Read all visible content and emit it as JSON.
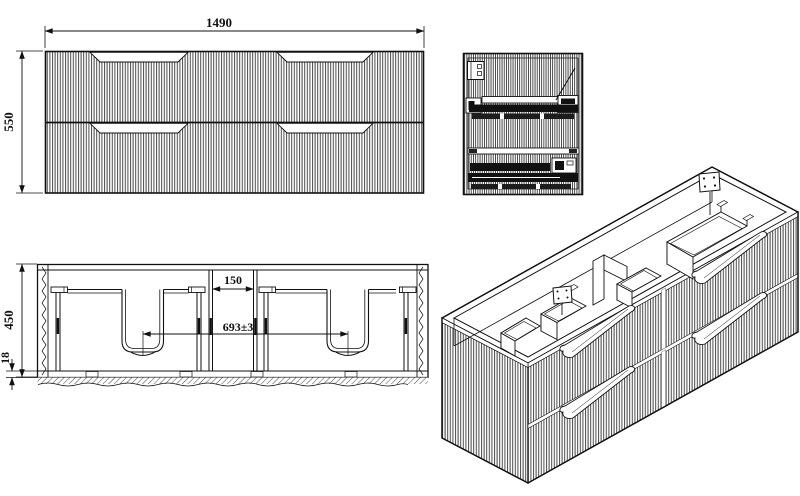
{
  "drawing": {
    "colors": {
      "line": "#111111",
      "flute": "#4a4a4a",
      "background": "#ffffff"
    },
    "dims": {
      "front_width": "1490",
      "front_height": "550",
      "cabinet_depth": "450",
      "bottom_thickness": "18",
      "center_gap": "150",
      "drain_spacing": "693±3"
    }
  }
}
